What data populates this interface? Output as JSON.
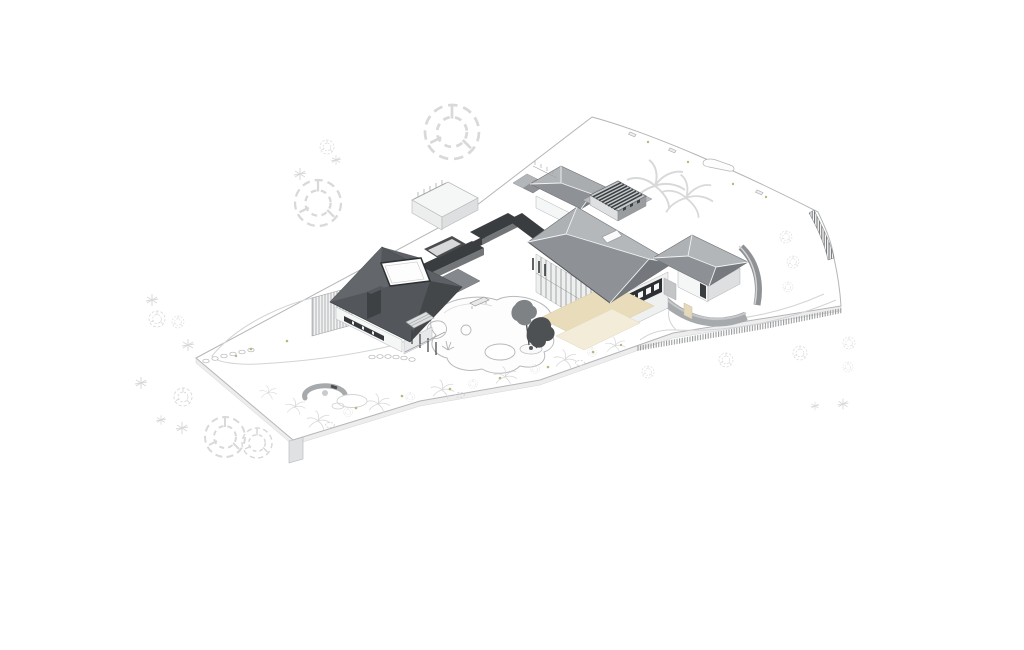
{
  "scene": {
    "description": "Axonometric architectural site drawing of a single-storey residence on a white site plate",
    "view": "axonometric",
    "components": [
      "site-plate",
      "site-boundary",
      "boundary-fence-hatched",
      "left-wing-dark-roof",
      "flat-rooflight",
      "chimney",
      "slatted-screen-fence",
      "link-corridors-dark",
      "garage-pavilion",
      "main-pavilion",
      "roof-monitor-louvers",
      "roof-skylight",
      "veranda-colonnade",
      "timber-deck-floor",
      "clerestory-window-band",
      "right-pavilion",
      "curved-stone-walls",
      "driveway",
      "courtyard-pond",
      "pond-island",
      "specimen-trees",
      "spiral-garden-feature",
      "stepping-stones",
      "garden-bench",
      "sketched-trees",
      "shrub-border",
      "plate-support-leg"
    ]
  },
  "palette": {
    "background": "#ffffff",
    "line-light": "#d2d4d5",
    "line-mid": "#b3b5b7",
    "tree-light": "#d7d9da",
    "green-accent": "#b3ba7e",
    "roof-top": "#b2b6b9",
    "roof-face": "#8e9296",
    "roof-side": "#777b7f",
    "roof-dark-face": "#53565a",
    "roof-dark-mid": "#63666a",
    "roof-darkest": "#44474a",
    "parapet-dark": "#3a3d40",
    "parapet-side": "#737679",
    "wall-white": "#f5f6f6",
    "wall-shade": "#dddfe0",
    "window-dark": "#2d3033",
    "floor-beige": "#e9dcba",
    "floor-beige-light": "#f3ecd9",
    "stone-wall": "#a7aaad",
    "stone-wall-dark": "#8f9295",
    "hatch-dark": "#6f7275",
    "hatch-mid": "#8e9193",
    "plate-side": "#ededee",
    "pond-line": "#b7b9bb",
    "tree-dark": "#4e5154",
    "tree-mid": "#7f8285"
  }
}
